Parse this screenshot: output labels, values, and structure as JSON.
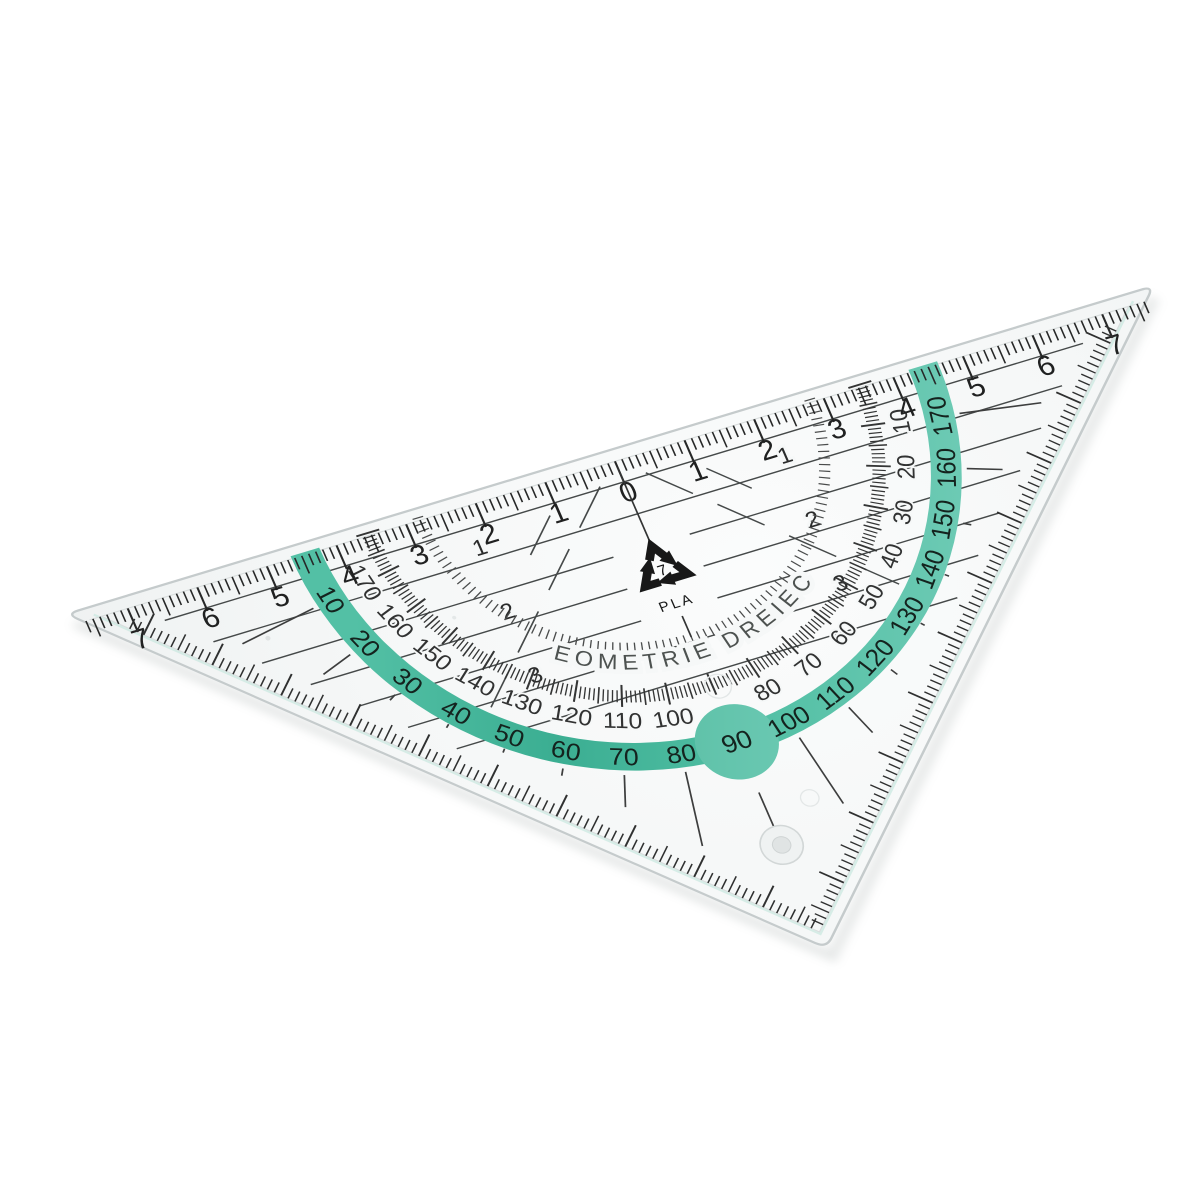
{
  "image": {
    "description_label": "Transparent plastic geometry set square (Geodreieck) product photo on white background"
  },
  "triangle": {
    "brand_text": "GEOMETRIE DREIECK",
    "material": {
      "recycling_code": "7",
      "material_label": "PLA"
    },
    "ruler_scale": {
      "left_values": [
        "7",
        "6",
        "5",
        "4",
        "3",
        "2",
        "1"
      ],
      "zero_value": "0",
      "right_values": [
        "1",
        "2",
        "3",
        "4",
        "5",
        "6",
        "7"
      ]
    },
    "protractor": {
      "band_values": [
        "10",
        "20",
        "30",
        "40",
        "50",
        "60",
        "70",
        "80",
        "100",
        "110",
        "120",
        "130",
        "140",
        "150",
        "160",
        "170"
      ],
      "highlighted_value": "90",
      "inner_values": [
        "170",
        "160",
        "150",
        "140",
        "130",
        "120",
        "110",
        "100",
        "80",
        "70",
        "60",
        "50",
        "40",
        "30",
        "20",
        "10"
      ]
    },
    "parallel_line_labels": [
      "1",
      "2",
      "3"
    ],
    "colors": {
      "band_green": "#53c0a5",
      "band_green_light": "#72ccb7",
      "band_green_dark": "#3bae92",
      "tick_dark": "#2b2c2c",
      "body_tint": "#f5f7f7",
      "edge_line": "#c5cbcc",
      "brand_text_color": "#4d5250",
      "band_number_color": "#14231e"
    }
  }
}
